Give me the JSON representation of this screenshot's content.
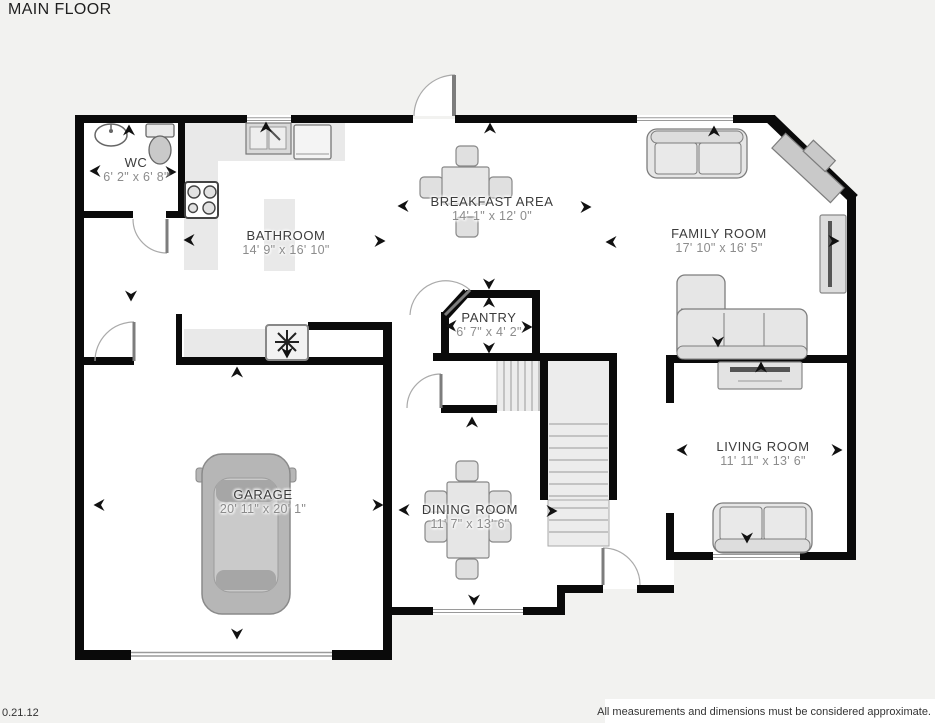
{
  "title": "MAIN FLOOR",
  "rooms": {
    "wc": {
      "name": "WC",
      "dims": "6' 2\" x 6' 8\""
    },
    "bathroom": {
      "name": "BATHROOM",
      "dims": "14' 9\" x 16' 10\""
    },
    "breakfast": {
      "name": "BREAKFAST AREA",
      "dims": "14' 1\" x 12' 0\""
    },
    "family": {
      "name": "FAMILY ROOM",
      "dims": "17' 10\" x 16' 5\""
    },
    "pantry": {
      "name": "PANTRY",
      "dims": "6' 7\" x 4' 2\""
    },
    "garage": {
      "name": "GARAGE",
      "dims": "20' 11\" x 20' 1\""
    },
    "dining": {
      "name": "DINING ROOM",
      "dims": "11' 7\" x 13' 6\""
    },
    "living": {
      "name": "LIVING ROOM",
      "dims": "11' 11\" x 13' 6\""
    }
  },
  "footer": {
    "version": "0.21.12",
    "disclaimer": "All measurements and dimensions must be considered approximate."
  },
  "colors": {
    "wall": "#0a0a0a",
    "background": "#f2f2f0",
    "room_fill": "#ffffff",
    "furniture_fill": "#e6e6e6",
    "furniture_stroke": "#7d7d7d",
    "stairs_fill": "#ececec",
    "label_text": "#3c3c3c",
    "dims_text": "#8c8c8c"
  }
}
